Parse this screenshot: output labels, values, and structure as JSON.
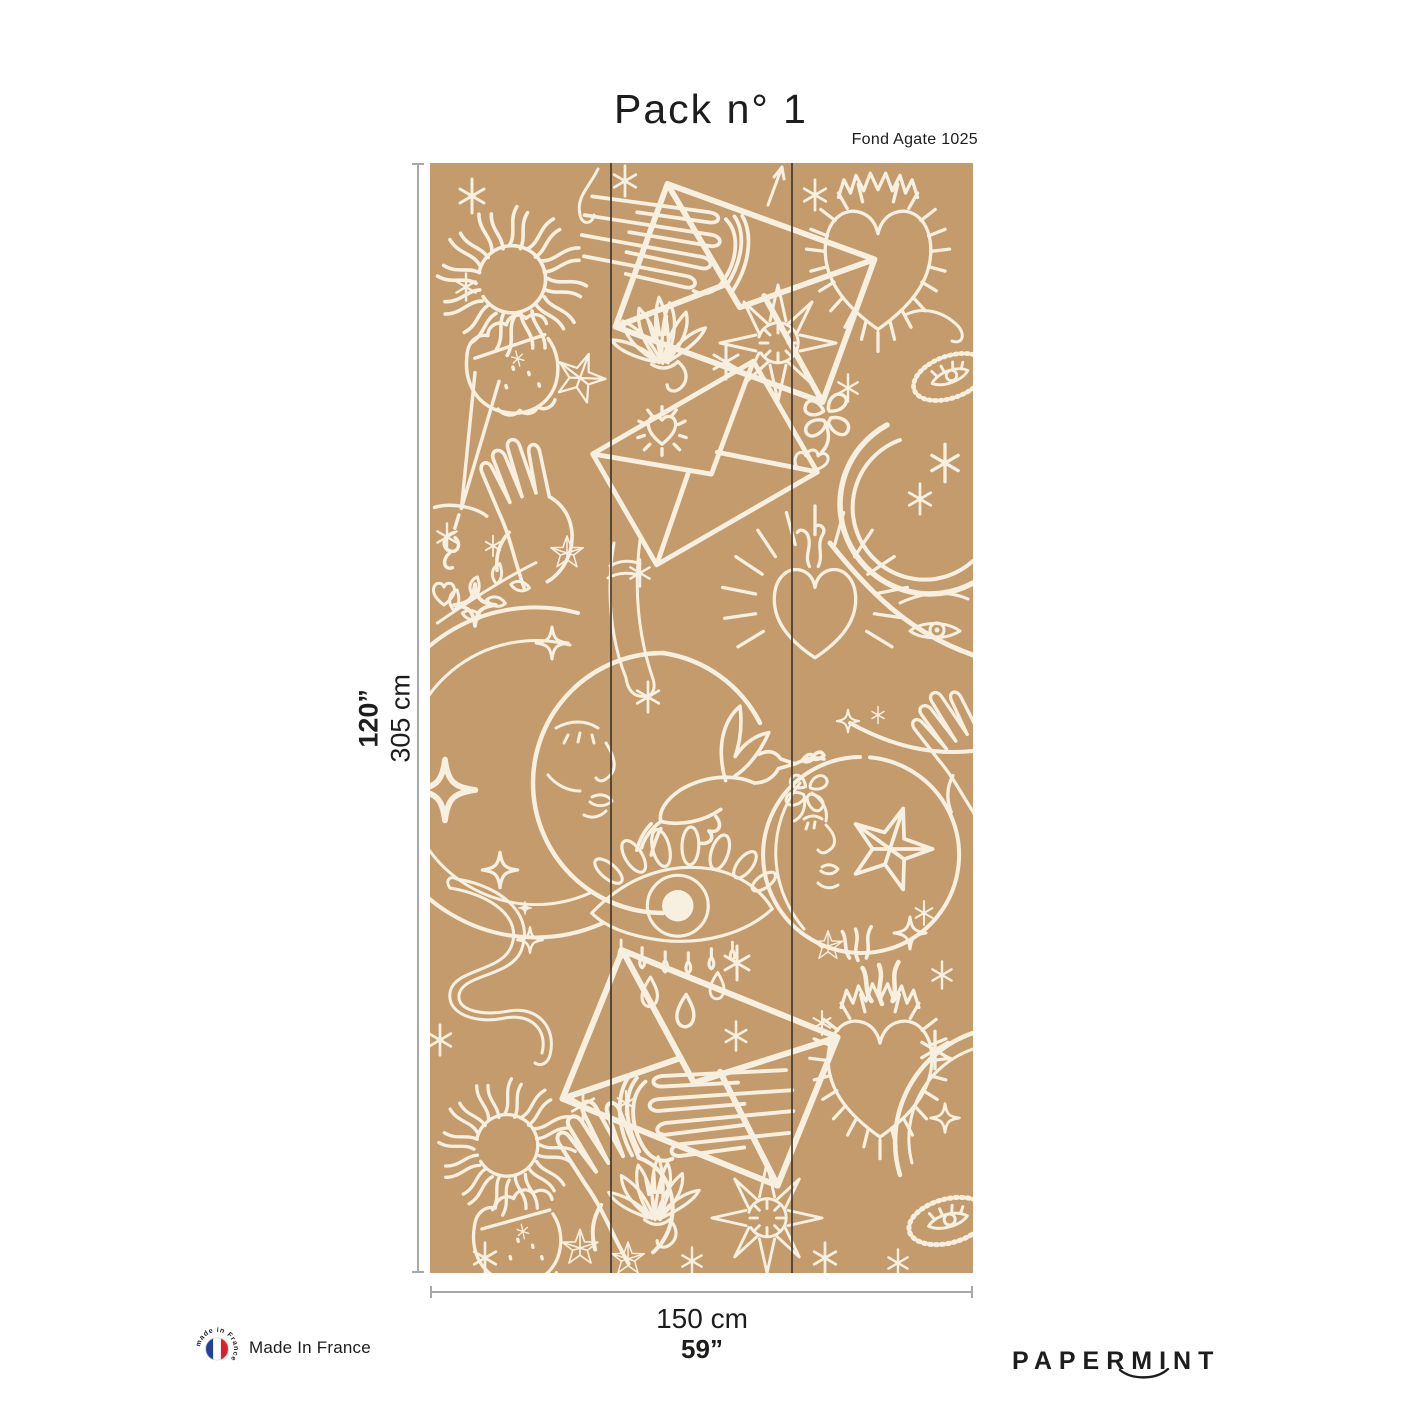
{
  "page": {
    "title": "Pack n° 1",
    "variant": "Fond Agate 1025",
    "brand": "PAPERMINT"
  },
  "dimensions": {
    "height_in": "120”",
    "height_cm": "305 cm",
    "width_cm": "150 cm",
    "width_in": "59”"
  },
  "footer": {
    "made_in_label": "Made In France",
    "badge_text": "made in France"
  },
  "wallpaper": {
    "panels": 3,
    "background_color": "#c49b6d",
    "line_color": "#f7f0e0",
    "motifs": [
      "flaming-sun",
      "fringed-sacred-heart",
      "flaming-sacred-heart",
      "crescent-moon-face",
      "moon-face-circle",
      "thick-crescent-moon",
      "all-seeing-eye-with-tears",
      "dove-with-olive-branch",
      "open-hand",
      "flat-hand",
      "gloved-hand-ruffled-cuff",
      "envelope",
      "radiant-heart-seal",
      "snake",
      "dagger",
      "lotus",
      "four-leaf-clover",
      "eye-amulet",
      "five-point-star",
      "eight-point-star-sun",
      "sparkles",
      "leaf-branch"
    ]
  },
  "colors": {
    "text": "#1d1d1b",
    "dimension_line": "#a8a8a8",
    "flag_blue": "#20409a",
    "flag_red": "#d7222e"
  }
}
